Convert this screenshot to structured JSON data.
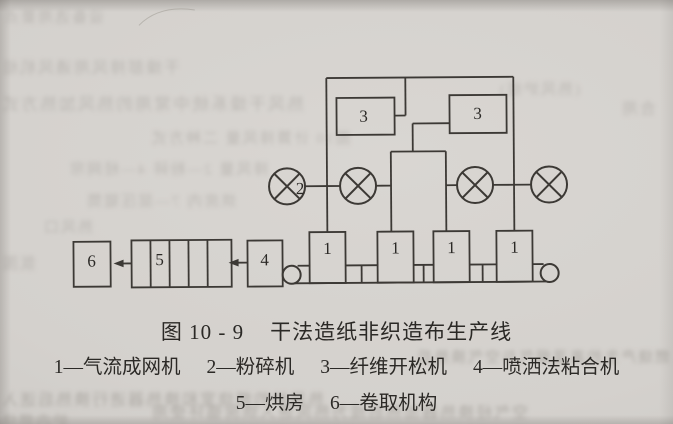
{
  "figure": {
    "number": "图 10 - 9",
    "title": "干法造纸非织造布生产线"
  },
  "legend": {
    "row1": [
      {
        "text": "1—气流成网机"
      },
      {
        "text": "2—粉碎机"
      },
      {
        "text": "3—纤维开松机"
      },
      {
        "text": "4—喷洒法粘合机"
      }
    ],
    "row2": [
      {
        "text": "5—烘房"
      },
      {
        "text": "6—卷取机构"
      }
    ]
  },
  "diagram": {
    "machine_labels": {
      "air_lay_former": "1",
      "crusher": "2",
      "fiber_opener": "3",
      "spray_bonder": "4",
      "drying_room": "5",
      "winder": "6"
    }
  },
  "colors": {
    "paper": "#d4d1cd",
    "ink": "#3c3935",
    "text": "#2b2926"
  },
  "background_noise": [
    "设备选用要点",
    "干燥部排风用通风机组",
    "热风干燥系统中常用的热风加热方式",
    "(热风炉组)",
    "图10 计算排风量 二种方式",
    "排风量 2—粉碎 4—经网帘",
    "烘房内 7—层压辊筒",
    "热风口",
    "合用",
    "氛围",
    "燃烧产生的高温烟气与空气换热后",
    "热风炉的燃烧室和换热器进行换热后送入",
    "空气经换热器加热后成为热风进入烘房循环使用",
    "炉内燃烧"
  ]
}
